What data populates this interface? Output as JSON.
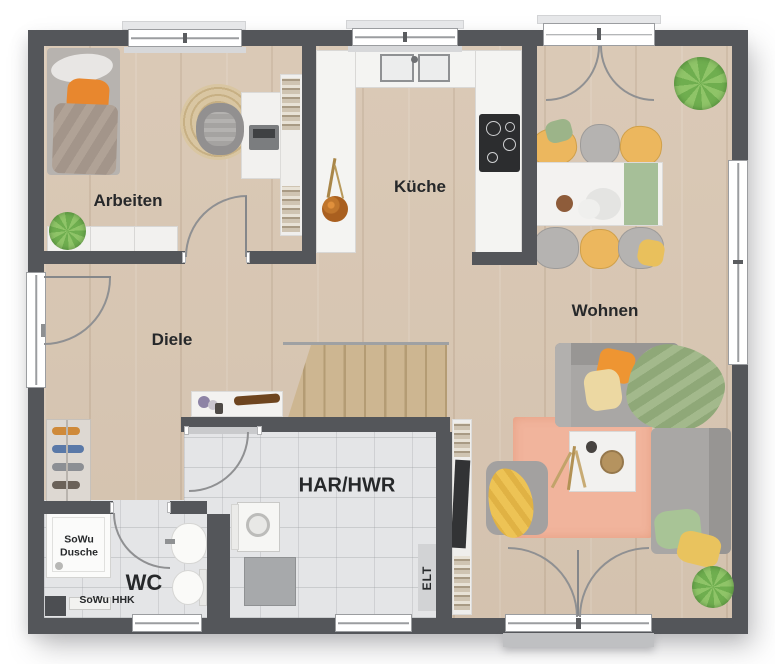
{
  "rooms": {
    "arbeiten": {
      "label": "Arbeiten"
    },
    "kueche": {
      "label": "Küche"
    },
    "diele": {
      "label": "Diele"
    },
    "wohnen": {
      "label": "Wohnen"
    },
    "har_hwr": {
      "label": "HAR/HWR"
    },
    "wc": {
      "label": "WC"
    }
  },
  "annotations": {
    "shower": {
      "label": "SoWu\nDusche"
    },
    "hhk": {
      "label": "SoWu HHK"
    },
    "elt": {
      "label": "ELT"
    }
  },
  "colors": {
    "wall": "#54565a",
    "wood_floor": "#d8c6b2",
    "tile_floor": "#e4e5e7",
    "kitchen_counter": "#f4f4f2",
    "rug_living": "#f1b49c",
    "rug_round": "#d9c6a2",
    "accent_orange": "#ee9532",
    "accent_yellow": "#e9c35e",
    "accent_green": "#9bb585",
    "sofa_gray": "#a9a7a5",
    "terrace": "#bfc0c2"
  }
}
